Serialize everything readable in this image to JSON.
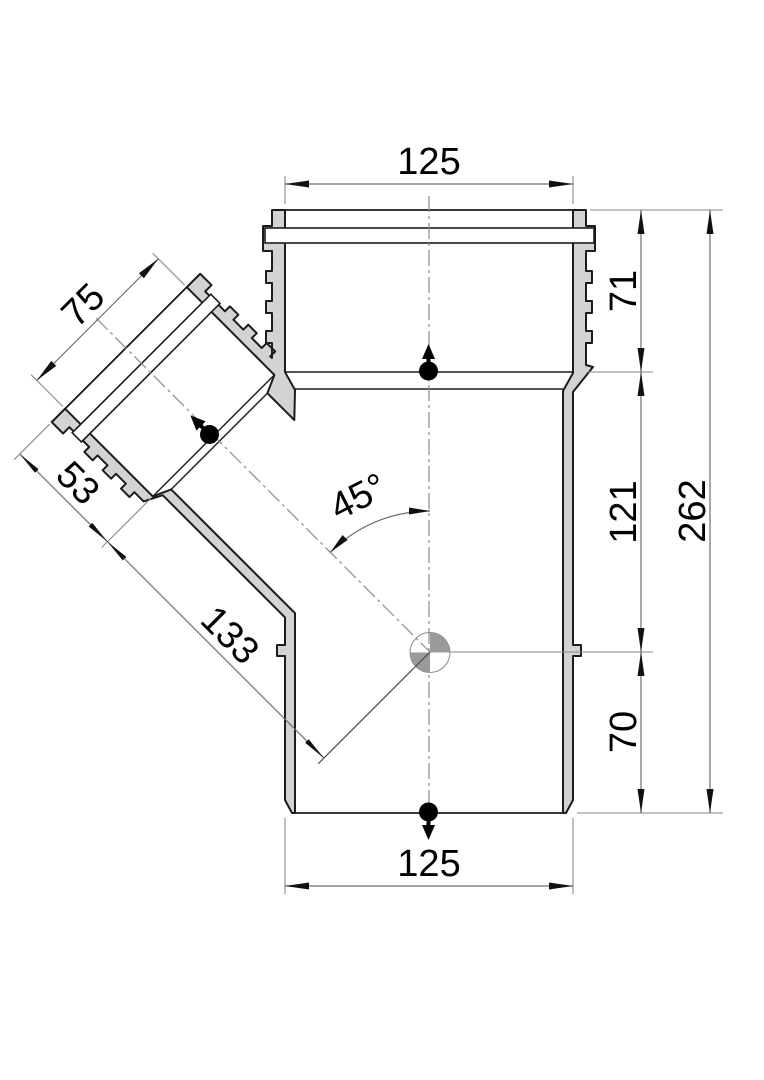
{
  "drawing": {
    "title": "45-degree branch pipe fitting, dimensioned section view",
    "type": "technical-drawing",
    "units": "mm",
    "dimensions": {
      "top_socket_width": "125",
      "socket_depth": "71",
      "mid_length": "121",
      "total_length": "262",
      "lower_length": "70",
      "bottom_width": "125",
      "branch_diameter": "75",
      "branch_socket_depth": "53",
      "branch_to_axis": "133",
      "branch_angle": "45°"
    },
    "colors": {
      "body_fill": "#d3d3d3",
      "outline": "#1c1c1c",
      "dimension_lines": "#6f6f6f",
      "centerlines": "#8a8a8a",
      "text": "#000000",
      "groove": "#ffffff",
      "center_mark_quadrant": "#9a9a9a"
    },
    "symbols": {
      "flow_marker": "dot with direction arrow",
      "center_mark": "circle with shaded quadrants"
    }
  }
}
